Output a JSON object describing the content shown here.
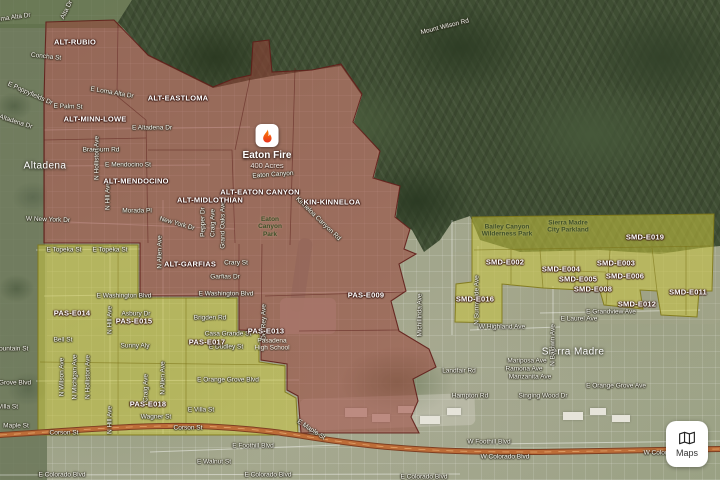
{
  "app": {
    "maps_button_label": "Maps"
  },
  "fire_marker": {
    "name": "Eaton Fire",
    "size": "400 Acres",
    "x": 267,
    "y": 137
  },
  "colors": {
    "evac_order_fill": "#99423 8",
    "evac_order_stroke": "#601e1a",
    "evac_warning_fill": "#cac640",
    "evac_warning_stroke": "#807818",
    "freeway": "#bd6d38",
    "flame_top": "#ff8a00",
    "flame_bottom": "#e8301f"
  },
  "places": [
    {
      "text": "Altadena",
      "x": 45,
      "y": 166
    },
    {
      "text": "Sierra Madre",
      "x": 573,
      "y": 352
    }
  ],
  "zones": {
    "order_labels": [
      {
        "text": "ALT-RUBIO",
        "x": 75,
        "y": 43
      },
      {
        "text": "ALT-EASTLOMA",
        "x": 178,
        "y": 99
      },
      {
        "text": "ALT-MINN-LOWE",
        "x": 95,
        "y": 120
      },
      {
        "text": "ALT-MENDOCINO",
        "x": 136,
        "y": 182
      },
      {
        "text": "ALT-MIDLOTHIAN",
        "x": 210,
        "y": 201
      },
      {
        "text": "ALT-EATON CANYON",
        "x": 260,
        "y": 193
      },
      {
        "text": "KIN-KINNELOA",
        "x": 332,
        "y": 203
      },
      {
        "text": "ALT-GARFIAS",
        "x": 190,
        "y": 265
      },
      {
        "text": "PAS-E009",
        "x": 366,
        "y": 296
      },
      {
        "text": "PAS-E013",
        "x": 266,
        "y": 332
      }
    ],
    "warning_labels": [
      {
        "text": "PAS-E014",
        "x": 72,
        "y": 314
      },
      {
        "text": "PAS-E015",
        "x": 134,
        "y": 322
      },
      {
        "text": "PAS-E017",
        "x": 207,
        "y": 343
      },
      {
        "text": "PAS-E018",
        "x": 148,
        "y": 405
      },
      {
        "text": "SMD-E019",
        "x": 645,
        "y": 238
      },
      {
        "text": "SMD-E002",
        "x": 505,
        "y": 263
      },
      {
        "text": "SMD-E004",
        "x": 561,
        "y": 270
      },
      {
        "text": "SMD-E003",
        "x": 616,
        "y": 264
      },
      {
        "text": "SMD-E006",
        "x": 625,
        "y": 277
      },
      {
        "text": "SMD-E005",
        "x": 578,
        "y": 280
      },
      {
        "text": "SMD-E008",
        "x": 593,
        "y": 290
      },
      {
        "text": "SMD-E011",
        "x": 688,
        "y": 293
      },
      {
        "text": "SMD-E012",
        "x": 637,
        "y": 305
      },
      {
        "text": "SMD-E016",
        "x": 475,
        "y": 300
      }
    ]
  },
  "parks": [
    {
      "lines": [
        "Bailey Canyon",
        "Wilderness Park"
      ],
      "x": 507,
      "y": 231
    },
    {
      "lines": [
        "Sierra Madre",
        "City Parkland"
      ],
      "x": 568,
      "y": 227
    },
    {
      "lines": [
        "Eaton",
        "Canyon",
        "Park"
      ],
      "x": 270,
      "y": 227
    }
  ],
  "pois": [
    {
      "lines": [
        "Pasadena",
        "High School"
      ],
      "x": 272,
      "y": 345
    }
  ],
  "streets": [
    {
      "text": "Mount Wilson Rd",
      "x": 445,
      "y": 27,
      "rot": -14
    },
    {
      "text": "Loma Alta Dr",
      "x": 12,
      "y": 18,
      "rot": -8
    },
    {
      "text": "Alta Dr",
      "x": 67,
      "y": 10,
      "rot": -64
    },
    {
      "text": "Concha St",
      "x": 46,
      "y": 57,
      "rot": 6
    },
    {
      "text": "E Poppyfields Dr",
      "x": 30,
      "y": 94,
      "rot": 24
    },
    {
      "text": "E Loma Alta Dr",
      "x": 112,
      "y": 93,
      "rot": 10
    },
    {
      "text": "E Palm St",
      "x": 68,
      "y": 107,
      "rot": 2
    },
    {
      "text": "W Altadena Dr",
      "x": 12,
      "y": 121,
      "rot": 18
    },
    {
      "text": "E Altadena Dr",
      "x": 152,
      "y": 128,
      "rot": 0
    },
    {
      "text": "Braeburn Rd",
      "x": 101,
      "y": 150,
      "rot": 0
    },
    {
      "text": "E Mendocino St",
      "x": 128,
      "y": 165,
      "rot": 0
    },
    {
      "text": "Morada Pl",
      "x": 137,
      "y": 211,
      "rot": 0
    },
    {
      "text": "New York Dr",
      "x": 177,
      "y": 224,
      "rot": 16
    },
    {
      "text": "W New York Dr",
      "x": 48,
      "y": 220,
      "rot": 2
    },
    {
      "text": "E Topeka St",
      "x": 64,
      "y": 250,
      "rot": 0
    },
    {
      "text": "E Topeka St",
      "x": 110,
      "y": 250,
      "rot": 0
    },
    {
      "text": "E Washington Blvd",
      "x": 124,
      "y": 296,
      "rot": 0
    },
    {
      "text": "E Washington Blvd",
      "x": 226,
      "y": 294,
      "rot": 0
    },
    {
      "text": "Crary St",
      "x": 236,
      "y": 263,
      "rot": 0
    },
    {
      "text": "Garfias Dr",
      "x": 225,
      "y": 277,
      "rot": 0
    },
    {
      "text": "Asbury Dr",
      "x": 136,
      "y": 314,
      "rot": 0
    },
    {
      "text": "Brigden Rd",
      "x": 210,
      "y": 318,
      "rot": 0
    },
    {
      "text": "Casa Grande St",
      "x": 228,
      "y": 334,
      "rot": 0
    },
    {
      "text": "E Dudley St",
      "x": 226,
      "y": 347,
      "rot": 0
    },
    {
      "text": "Bell St",
      "x": 63,
      "y": 340,
      "rot": 0
    },
    {
      "text": "Sunny Aly",
      "x": 135,
      "y": 346,
      "rot": 0
    },
    {
      "text": "E Orange Grove Blvd",
      "x": 228,
      "y": 380,
      "rot": 0
    },
    {
      "text": "Grove Blvd",
      "x": 15,
      "y": 383,
      "rot": 0
    },
    {
      "text": "E Villa St",
      "x": 201,
      "y": 410,
      "rot": 0
    },
    {
      "text": "Wagner St",
      "x": 156,
      "y": 417,
      "rot": 0
    },
    {
      "text": "Villa St",
      "x": 8,
      "y": 407,
      "rot": 0
    },
    {
      "text": "Mountain St",
      "x": 11,
      "y": 349,
      "rot": 0
    },
    {
      "text": "Maple St",
      "x": 16,
      "y": 426,
      "rot": 0
    },
    {
      "text": "Corson St",
      "x": 64,
      "y": 433,
      "rot": 0
    },
    {
      "text": "Corson St",
      "x": 188,
      "y": 428,
      "rot": 0
    },
    {
      "text": "E Maple St",
      "x": 311,
      "y": 430,
      "rot": 33
    },
    {
      "text": "E Foothill Blvd",
      "x": 253,
      "y": 446,
      "rot": 0
    },
    {
      "text": "E Walnut St",
      "x": 214,
      "y": 462,
      "rot": 0
    },
    {
      "text": "E Colorado Blvd",
      "x": 62,
      "y": 475,
      "rot": 0
    },
    {
      "text": "E Colorado Blvd",
      "x": 268,
      "y": 475,
      "rot": 0
    },
    {
      "text": "E Colorado Blvd",
      "x": 424,
      "y": 477,
      "rot": 0
    },
    {
      "text": "W Foothill Blvd",
      "x": 489,
      "y": 442,
      "rot": 0
    },
    {
      "text": "W Colorado Blvd",
      "x": 505,
      "y": 457,
      "rot": 0
    },
    {
      "text": "W Colorado Blvd",
      "x": 668,
      "y": 453,
      "rot": 0
    },
    {
      "text": "W Highland Ave",
      "x": 502,
      "y": 327,
      "rot": 0
    },
    {
      "text": "E Grandview Ave",
      "x": 611,
      "y": 312,
      "rot": 0
    },
    {
      "text": "E Laurel Ave",
      "x": 579,
      "y": 319,
      "rot": 0
    },
    {
      "text": "Landfair Rd",
      "x": 459,
      "y": 371,
      "rot": 0
    },
    {
      "text": "Hampton Rd",
      "x": 470,
      "y": 396,
      "rot": 0
    },
    {
      "text": "Mariposa Ave",
      "x": 527,
      "y": 361,
      "rot": 0
    },
    {
      "text": "Ramona Ave",
      "x": 524,
      "y": 369,
      "rot": 0
    },
    {
      "text": "Manzanita Ave",
      "x": 530,
      "y": 377,
      "rot": 0
    },
    {
      "text": "Singing Wood Dr",
      "x": 543,
      "y": 396,
      "rot": 0
    },
    {
      "text": "E Orange Grove Ave",
      "x": 616,
      "y": 386,
      "rot": 0
    },
    {
      "text": "Eaton Canyon",
      "x": 273,
      "y": 175,
      "rot": -4
    },
    {
      "text": "Kinneloa Canyon Rd",
      "x": 318,
      "y": 219,
      "rot": 44
    },
    {
      "text": "N Holliston Ave",
      "x": 97,
      "y": 158,
      "vertical": true
    },
    {
      "text": "N Hill Ave",
      "x": 108,
      "y": 196,
      "vertical": true
    },
    {
      "text": "N Allen Ave",
      "x": 160,
      "y": 252,
      "vertical": true
    },
    {
      "text": "Pepper Dr",
      "x": 203,
      "y": 222,
      "vertical": true
    },
    {
      "text": "Craig Ave",
      "x": 213,
      "y": 223,
      "vertical": true
    },
    {
      "text": "Grand Oaks Ave",
      "x": 223,
      "y": 225,
      "vertical": true
    },
    {
      "text": "N Hill Ave",
      "x": 110,
      "y": 320,
      "vertical": true
    },
    {
      "text": "N Hill Ave",
      "x": 110,
      "y": 420,
      "vertical": true
    },
    {
      "text": "N Wilson Ave",
      "x": 62,
      "y": 377,
      "vertical": true
    },
    {
      "text": "N Michigan Ave",
      "x": 75,
      "y": 377,
      "vertical": true
    },
    {
      "text": "N Holliston Ave",
      "x": 88,
      "y": 377,
      "vertical": true
    },
    {
      "text": "Craig Ave",
      "x": 146,
      "y": 388,
      "vertical": true
    },
    {
      "text": "N Allen Ave",
      "x": 163,
      "y": 378,
      "vertical": true
    },
    {
      "text": "Del Rey Ave",
      "x": 264,
      "y": 322,
      "vertical": true
    },
    {
      "text": "Michillinda Ave",
      "x": 420,
      "y": 315,
      "vertical": true
    },
    {
      "text": "N Sunnyside Ave",
      "x": 477,
      "y": 300,
      "vertical": true
    },
    {
      "text": "N Baldwin Ave",
      "x": 553,
      "y": 345,
      "vertical": true
    }
  ],
  "overlays": {
    "red_zone_path": "M46,22 L114,20 L148,55 L213,87 L233,79 L251,75 L253,42 L269,40 L272,72 L312,70 L341,64 L362,94 L353,122 L380,151 L373,178 L400,186 L395,217 L410,229 L404,249 L416,254 L399,264 L406,291 L391,301 L399,331 L429,349 L436,367 L413,379 L418,401 L411,417 L419,433 L301,433 L298,396 L287,390 L287,364 L261,360 L261,331 L239,330 L239,296 L140,296 L140,243 L44,243 L44,98 Z",
    "yellow_left_path": "M38,245 L138,245 L138,298 L237,298 L237,332 L259,332 L259,362 L285,366 L285,392 L296,398 L298,435 L38,435 Z",
    "yellow_right_path": "M472,217 L714,214 L712,291 L699,291 L697,317 L661,315 L657,291 L640,290 L643,309 L604,305 L600,291 L543,288 L502,284 L502,323 L455,322 L456,284 L472,282 Z",
    "red_border_paths": [
      "M118,22 L117,96 L146,120",
      "M44,140 L146,138",
      "M146,120 L148,243",
      "M148,150 L232,150 L235,243",
      "M235,150 L250,78",
      "M295,68 L290,245",
      "M239,244 L239,296",
      "M262,244 L261,331",
      "M265,296 L404,292",
      "M299,331 L399,330"
    ],
    "yellow_border_paths": [
      "M118,246 L118,434",
      "M186,298 L186,434",
      "M40,362 L285,365",
      "M474,250 L710,246",
      "M540,250 L543,288",
      "M575,250 L575,289",
      "M610,250 L606,305",
      "M652,248 L657,291",
      "M686,246 L686,315",
      "M511,250 L511,284",
      "M543,270 L606,272"
    ],
    "street_line_paths": [
      "M44,296 L430,291",
      "M36,381 L299,380",
      "M44,130 L250,127",
      "M44,166 L210,165",
      "M44,221 L235,229",
      "M46,24 L46,434",
      "M110,244 L110,434",
      "M163,200 L163,434",
      "M452,220 L452,335",
      "M478,246 L478,330",
      "M553,286 L553,370",
      "M36,250 L140,249",
      "M540,313 L700,310",
      "M470,330 L560,327",
      "M150,452 L340,445",
      "M0,475 L460,474",
      "M490,444 L720,441"
    ],
    "freeway_path": "M0,435 C70,431 150,423 218,427 C292,431 318,441 388,447 C436,451 470,452 540,452 L720,449"
  }
}
